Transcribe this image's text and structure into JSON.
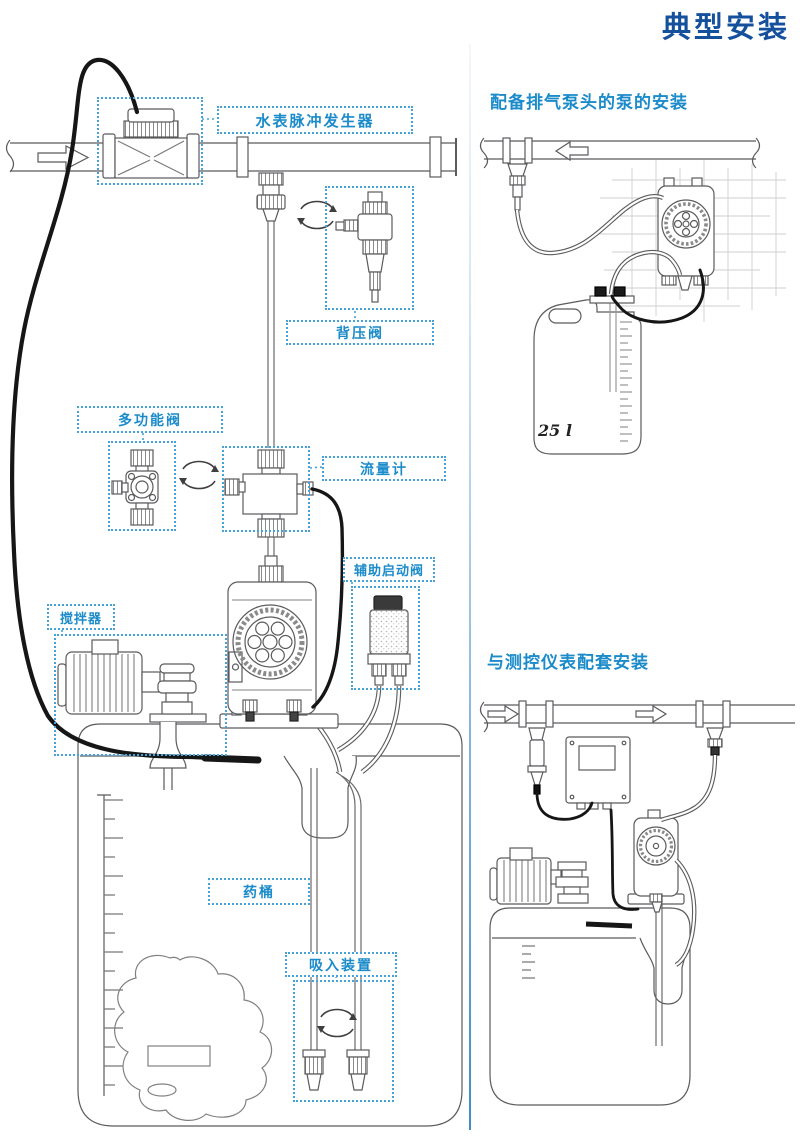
{
  "title": "典型安装",
  "main_diagram": {
    "labels": {
      "water_meter_pulse_generator": "水表脉冲发生器",
      "back_pressure_valve": "背压阀",
      "multifunction_valve": "多功能阀",
      "flow_meter": "流量计",
      "auxiliary_priming_valve": "辅助启动阀",
      "agitator": "搅拌器",
      "chemical_tank": "药桶",
      "suction_device": "吸入装置"
    }
  },
  "right_top_panel": {
    "heading": "配备排气泵头的泵的安装",
    "canister_capacity_label": "25 l"
  },
  "right_bottom_panel": {
    "heading": "与测控仪表配套安装"
  },
  "colors": {
    "title_blue": "#15509d",
    "heading_blue": "#1b8bca",
    "dotted_box_blue": "#45a3d9",
    "line_art_gray": "#5a5b5d",
    "cable_black": "#161616"
  }
}
